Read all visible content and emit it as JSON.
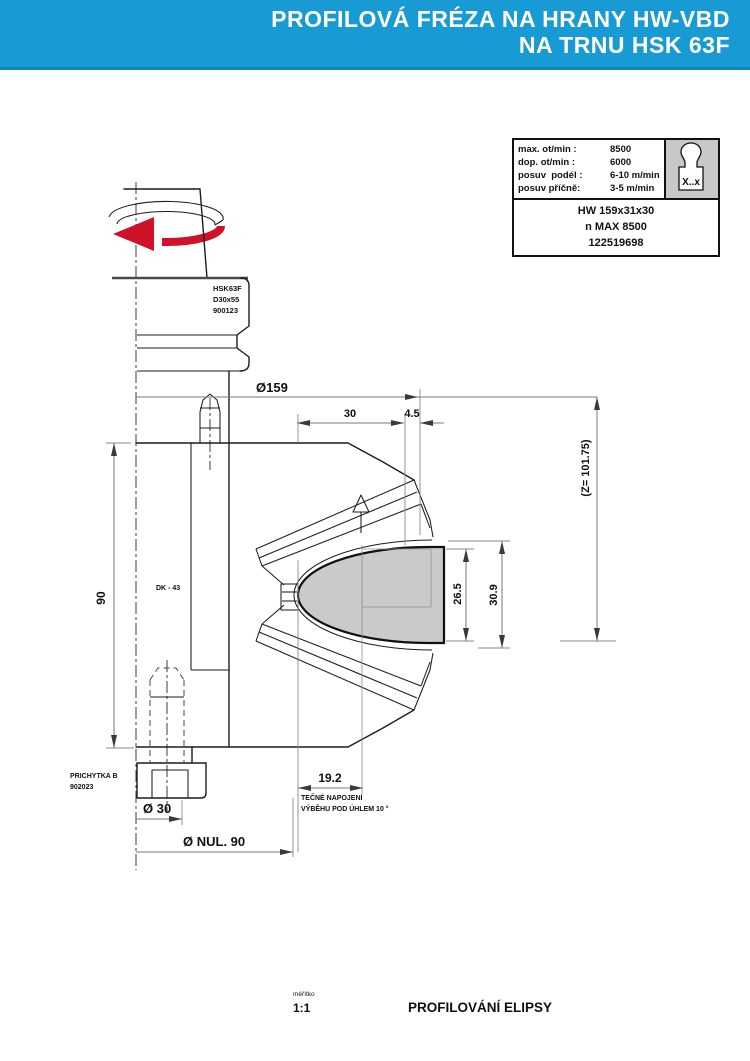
{
  "header": {
    "line1": "PROFILOVÁ FRÉZA NA HRANY HW-VBD",
    "line2": "NA TRNU HSK 63F"
  },
  "spec_table": {
    "rows": [
      {
        "label": "max. ot/min :",
        "value": "8500"
      },
      {
        "label": "dop. ot/min :",
        "value": "6000"
      },
      {
        "label": "posuv  podél :",
        "value": "6-10 m/min"
      },
      {
        "label": "posuv příčně:",
        "value": "3-5 m/min"
      }
    ],
    "icon_label": "X..x",
    "model": "HW 159x31x30",
    "speed": "n MAX 8500",
    "code": "122519698"
  },
  "drawing": {
    "labels": {
      "holder1": "HSK63F",
      "holder2": "D30x55",
      "holder3": "900123",
      "body": "DK - 43",
      "clamp1": "PRICHYTKA B",
      "clamp2": "902023",
      "note1": "TEČNÉ NAPOJENÍ",
      "note2": "VÝBĚHU POD ÚHLEM 10 °"
    },
    "dims": {
      "dia_cutter": "Ø159",
      "width_30": "30",
      "width_45": "4.5",
      "gauge_z": "(Z= 101.75)",
      "height_90": "90",
      "profile_h1": "26.5",
      "profile_h2": "30.9",
      "runout": "19.2",
      "dia_bore": "Ø 30",
      "dia_nul": "Ø NUL. 90"
    }
  },
  "footer": {
    "scale_label": "měřítko",
    "scale_value": "1:1",
    "title": "PROFILOVÁNÍ ELIPSY"
  },
  "colors": {
    "header_bg": "#189ad4",
    "accent_red": "#cf1228",
    "profile_gray": "#cacaca"
  }
}
